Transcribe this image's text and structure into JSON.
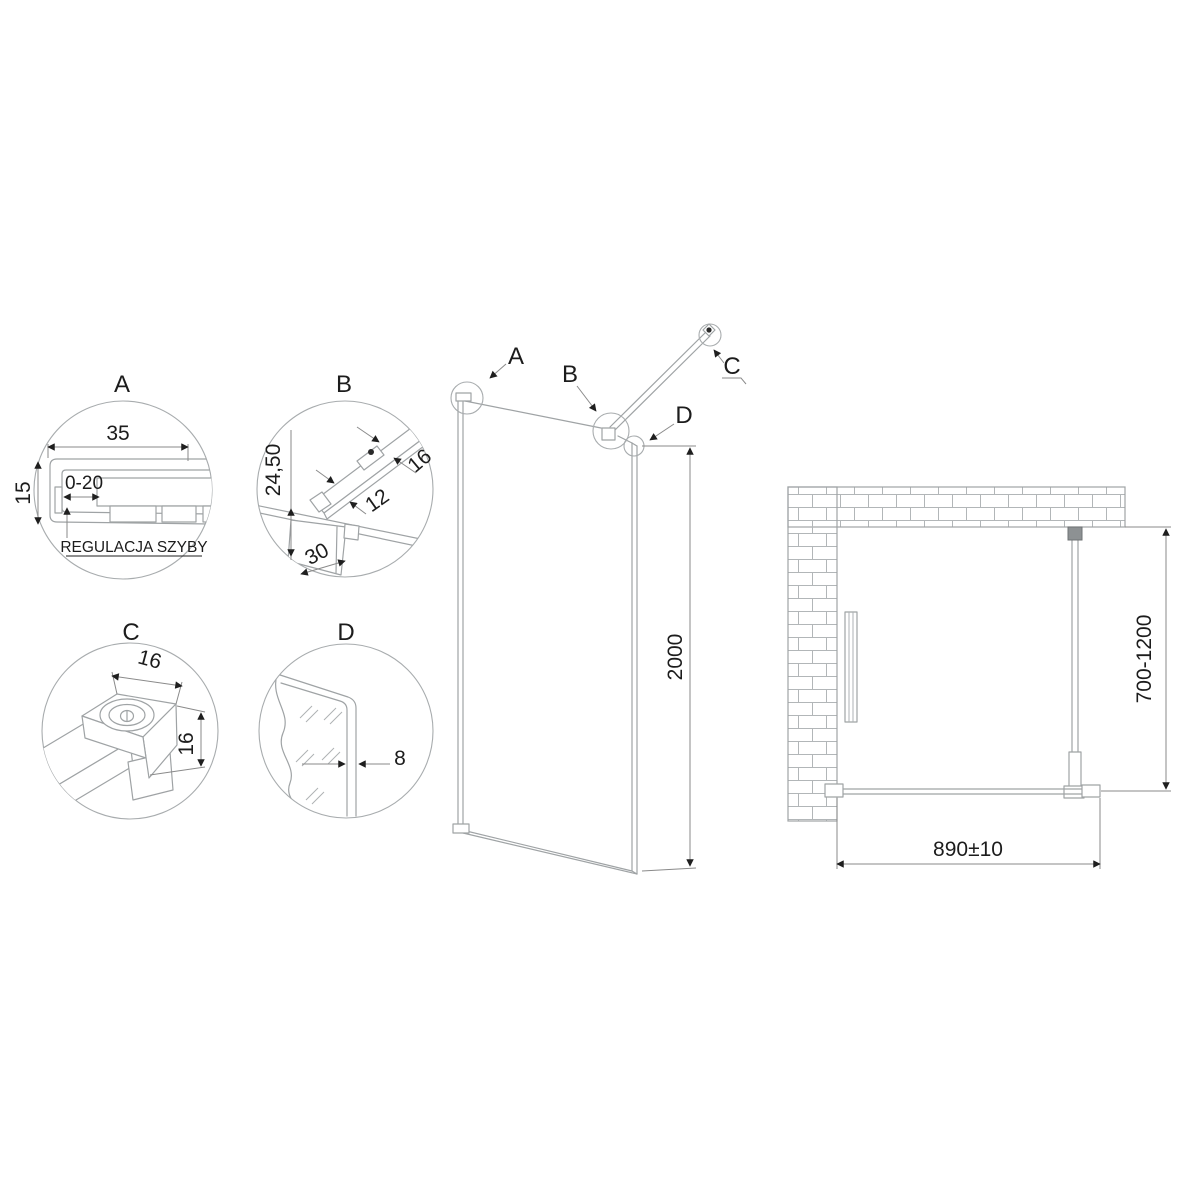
{
  "details": {
    "a": {
      "label": "A",
      "width": "35",
      "height": "15",
      "adjustment": "0-20",
      "note": "REGULACJA SZYBY"
    },
    "b": {
      "label": "B",
      "offset": "24,50",
      "bar_width": "16",
      "bar_height": "12",
      "clamp": "30"
    },
    "c": {
      "label": "C",
      "width": "16",
      "height": "16"
    },
    "d": {
      "label": "D",
      "glass_thickness": "8"
    }
  },
  "panel": {
    "callout_a": "A",
    "callout_b": "B",
    "callout_c": "C",
    "callout_d": "D",
    "height": "2000"
  },
  "plan": {
    "arm_range": "700-1200",
    "width": "890±10"
  },
  "colors": {
    "background": "#ffffff",
    "line": "#9fa3a5",
    "dimension": "#8a8a8a",
    "text": "#1c1c1c"
  }
}
